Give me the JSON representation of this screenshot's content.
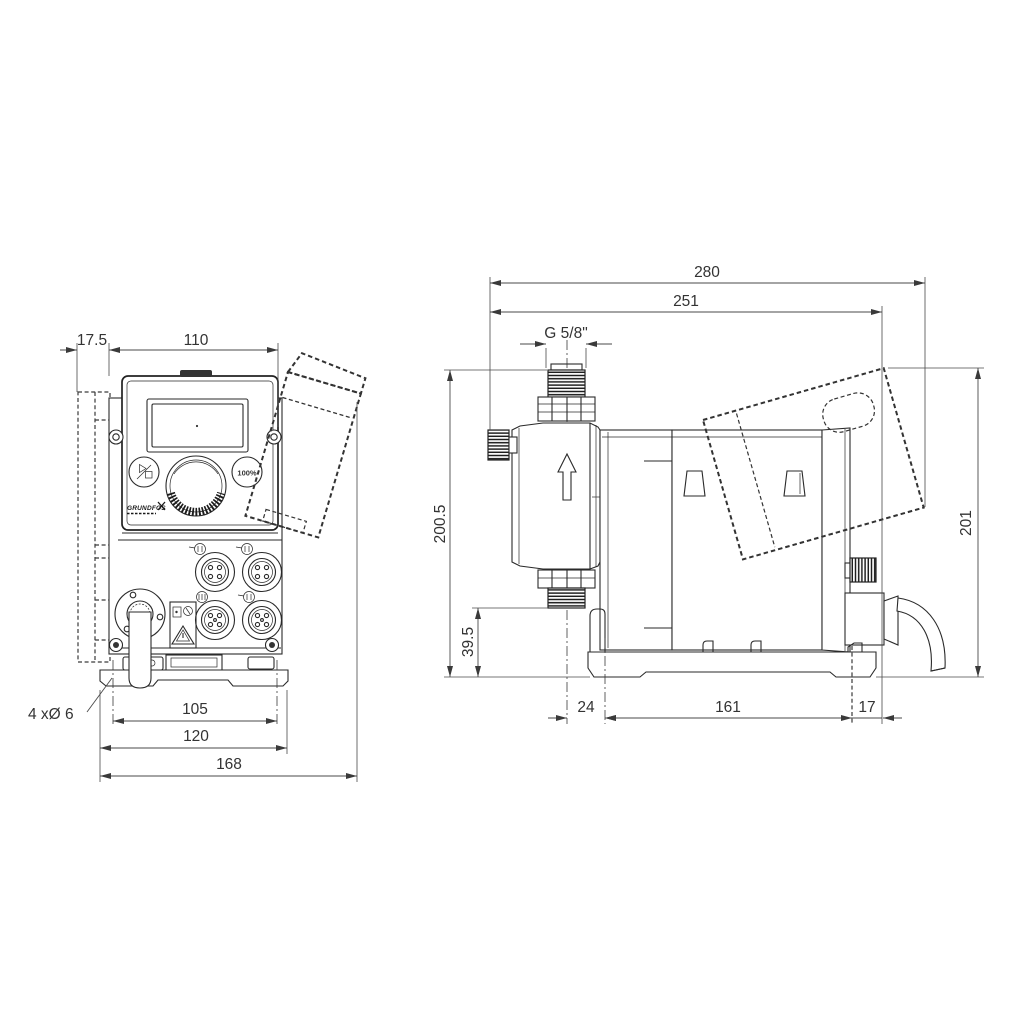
{
  "drawing": {
    "title": "dosing-pump-dimensional-drawing",
    "background_color": "#ffffff",
    "line_color": "#2a2a2a",
    "dimension_color": "#4a4a4a",
    "views": {
      "front_view": {
        "dimensions": {
          "wall_offset": "17.5",
          "top_width": "110",
          "hole_spacing": "105",
          "plate_width": "120",
          "overall_width": "168",
          "hole_note": "4 xØ 6"
        },
        "panel": {
          "hundred_percent_button": "100%",
          "logo": "GRUNDFOS"
        }
      },
      "side_view": {
        "dimensions": {
          "overall_depth": "280",
          "depth_to_cover": "251",
          "thread_size": "G 5/8\"",
          "total_height": "200.5",
          "suction_valve_height": "39.5",
          "cover_height": "201",
          "base_front_offset": "24",
          "base_hole_spacing": "161",
          "base_rear_offset": "17"
        }
      }
    },
    "icons": {
      "start_stop": "play-stop-icon",
      "click_wheel": "click-wheel",
      "connectors": "m12-connector-sockets",
      "warning": "warning-triangle-icon",
      "flow": "flow-direction-arrow-up"
    }
  }
}
